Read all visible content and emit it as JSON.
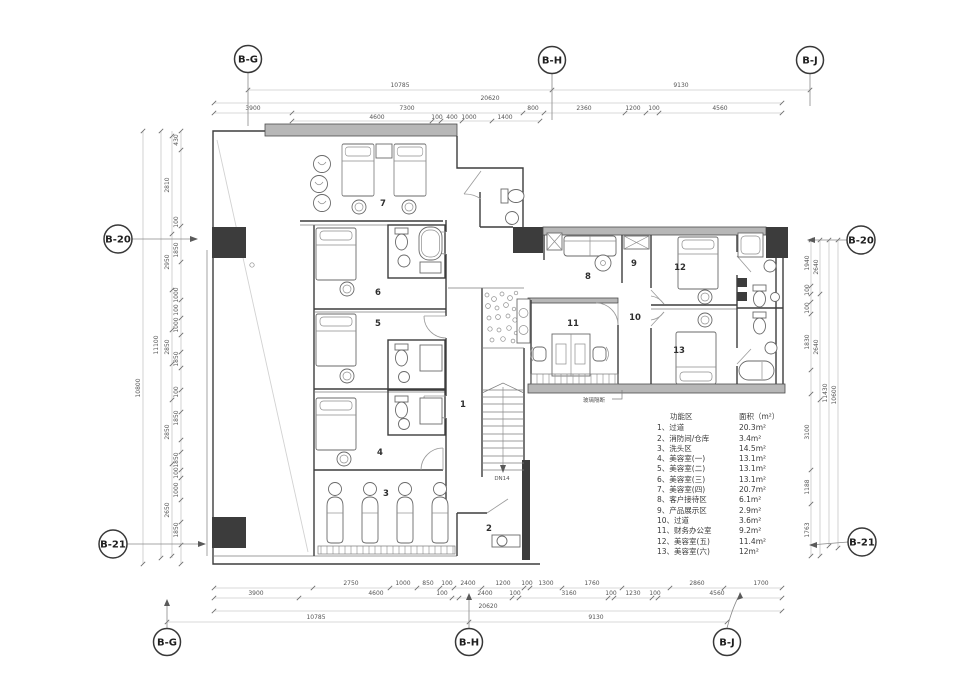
{
  "grid_bubbles": {
    "top": [
      "B-G",
      "B-H",
      "B-J"
    ],
    "bottom": [
      "B-G",
      "B-H",
      "B-J"
    ],
    "left": [
      "B-20",
      "B-21"
    ],
    "right": [
      "B-20",
      "B-21"
    ]
  },
  "plan_numbers": [
    "1",
    "2",
    "3",
    "4",
    "5",
    "6",
    "7",
    "8",
    "9",
    "10",
    "11",
    "12",
    "13"
  ],
  "annotations": {
    "stair": "DN14",
    "glass_partition": "玻璃隔断"
  },
  "legend": {
    "header": {
      "zone": "功能区",
      "area": "面积（m²）"
    },
    "rows": [
      {
        "label": "1、过道",
        "area": "20.3m²"
      },
      {
        "label": "2、消防间/仓库",
        "area": "3.4m²"
      },
      {
        "label": "3、洗头区",
        "area": "14.5m²"
      },
      {
        "label": "4、美容室(一)",
        "area": "13.1m²"
      },
      {
        "label": "5、美容室(二)",
        "area": "13.1m²"
      },
      {
        "label": "6、美容室(三)",
        "area": "13.1m²"
      },
      {
        "label": "7、美容室(四)",
        "area": "20.7m²"
      },
      {
        "label": "8、客户接待区",
        "area": "6.1m²"
      },
      {
        "label": "9、产品展示区",
        "area": "2.9m²"
      },
      {
        "label": "10、过道",
        "area": "3.6m²"
      },
      {
        "label": "11、财务办公室",
        "area": "9.2m²"
      },
      {
        "label": "12、美容室(五)",
        "area": "11.4m²"
      },
      {
        "label": "13、美容室(六)",
        "area": "12m²"
      }
    ]
  },
  "dims": {
    "top_grid": [
      "10785",
      "9130"
    ],
    "top_overall": "20620",
    "top_a": [
      "3900",
      "7300",
      "800",
      "2360",
      "1200",
      "100",
      "4560"
    ],
    "top_b": [
      "4600",
      "100",
      "400",
      "1000",
      "1400"
    ],
    "bottom_a": [
      "2750",
      "1000",
      "850",
      "100",
      "2400",
      "1200",
      "100",
      "1300",
      "1760",
      "2860",
      "1700"
    ],
    "bottom_b": [
      "3900",
      "4600",
      "100",
      "2400",
      "100",
      "3160",
      "100",
      "1230",
      "100",
      "4560"
    ],
    "bottom_overall": "20620",
    "bottom_grid": [
      "10785",
      "9130"
    ],
    "left": [
      "430",
      "2810",
      "100",
      "1850",
      "2950",
      "1000",
      "100",
      "1000",
      "11100",
      "2850",
      "1850",
      "10800",
      "100",
      "1850",
      "2850",
      "1850",
      "100",
      "1000",
      "2650",
      "1850"
    ],
    "right": [
      "1940",
      "2640",
      "100",
      "100",
      "1830",
      "2640",
      "11430",
      "10600",
      "3100",
      "1188",
      "1763"
    ]
  },
  "colors": {
    "wall": "#3d3d3d",
    "wall_band": "#b7b7b7",
    "column": "#3c3c3c",
    "dim_line": "#b5b5b5",
    "dim_text": "#555555",
    "background": "#ffffff"
  }
}
